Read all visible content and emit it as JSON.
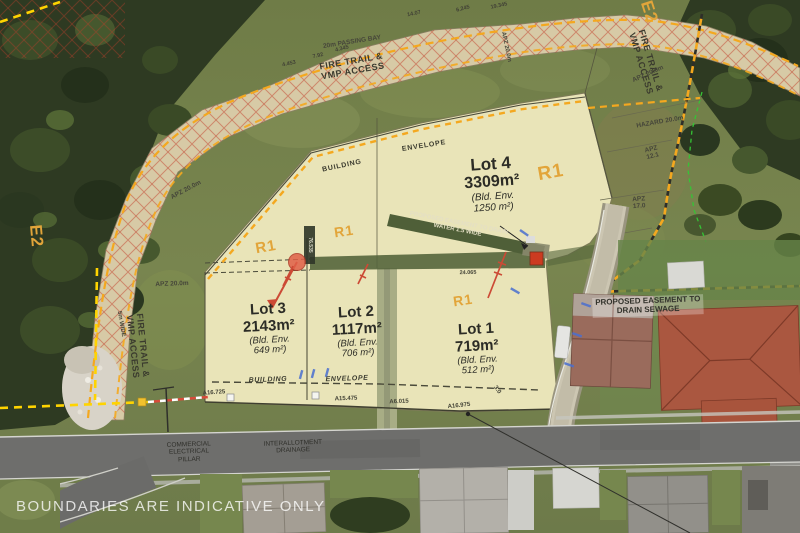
{
  "watermark": "BOUNDARIES ARE INDICATIVE ONLY",
  "zones": {
    "e2": "E2",
    "r1": "R1"
  },
  "lots": [
    {
      "name": "Lot 4",
      "area": "3309m²",
      "env_line1": "(Bld. Env.",
      "env_line2": "1250 m²)"
    },
    {
      "name": "Lot 3",
      "area": "2143m²",
      "env_line1": "(Bld. Env.",
      "env_line2": "649 m²)"
    },
    {
      "name": "Lot 2",
      "area": "1117m²",
      "env_line1": "(Bld. Env.",
      "env_line2": "706 m²)"
    },
    {
      "name": "Lot 1",
      "area": "719m²",
      "env_line1": "(Bld. Env.",
      "env_line2": "512 m²)"
    }
  ],
  "annotations": {
    "fire_trail_line1": "FIRE TRAIL &",
    "fire_trail_line2": "VMP ACCESS",
    "passing_bay": "20m PASSING BAY",
    "building": "BUILDING",
    "envelope": "ENVELOPE",
    "apz_20": "APZ 20.0m",
    "hazard_20": "HAZARD 20.0m",
    "apz_word": "APZ",
    "apz_12_val": "12.1",
    "apz_17_val": "17.0",
    "five_m_wide": "5m WIDE",
    "easement_water_line1": "PROPOSED EASEMENT TO DRAIN",
    "easement_water_line2": "WATER 1.5 WIDE",
    "easement_sewer_line1": "PROPOSED EASEMENT TO",
    "easement_sewer_line2": "DRAIN SEWAGE",
    "commercial_line1": "COMMERCIAL",
    "commercial_line2": "ELECTRICAL",
    "commercial_line3": "PILLAR",
    "interallotment_line1": "INTERALLOTMENT",
    "interallotment_line2": "DRAINAGE"
  },
  "measurements": {
    "top_1": "14.07",
    "top_2": "6.245",
    "top_3": "19.345",
    "trail_1": "4.453",
    "trail_2": "7.92",
    "trail_3": "4.345",
    "bottom_1": "A16.725",
    "bottom_2": "A15.475",
    "bottom_3": "A6.015",
    "bottom_4": "A16.975",
    "bottom_5": "3.0",
    "easement_len": "24.065",
    "lot_depth": "76.535"
  },
  "colors": {
    "boundary_orange": "#F4A81F",
    "boundary_yellow": "#FFD400",
    "zone_label_orange": "#E2A53A",
    "hatch_red": "#C23B2A",
    "easement_green": "#55653C",
    "lot_fill": "#E9E4B8",
    "watermark_white": "#FFFFFF"
  }
}
